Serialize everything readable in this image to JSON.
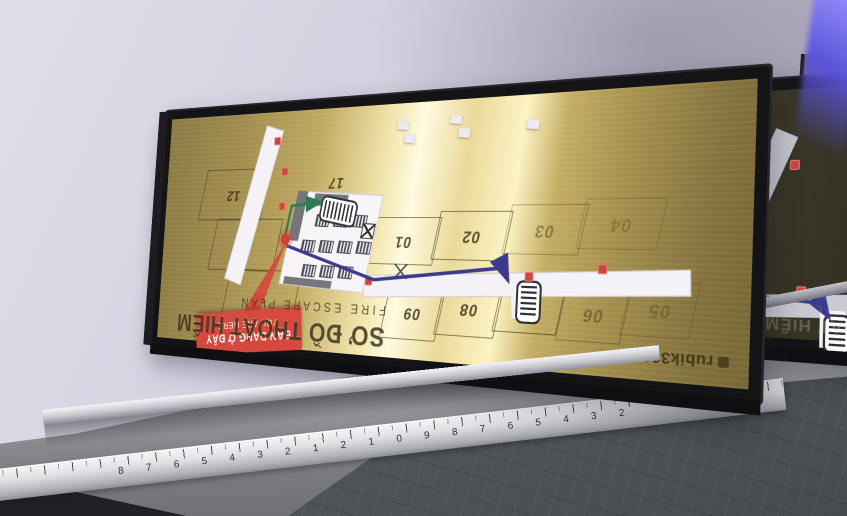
{
  "sign_main": {
    "title": "SƠ ĐỒ THOÁT HIỂM",
    "subtitle": "FIRE ESCAPE PLAN",
    "you_are_here": {
      "line1": "BẠN ĐANG Ở ĐÂY",
      "line2": "YOU ARE HERE"
    },
    "brand": "rubik360",
    "rooms": [
      "12",
      "11",
      "10",
      "17",
      "01",
      "02",
      "03",
      "04",
      "09",
      "08",
      "07",
      "06",
      "05"
    ],
    "icons": [
      "stairs-icon",
      "fire-extinguisher-icon",
      "elevator-icon",
      "door-swing-icon",
      "you-are-here-dot",
      "route-arrow",
      "desk-cluster-icon"
    ],
    "colors": {
      "brass": "#c9b46a",
      "frame": "#141417",
      "corridor": "#f4f2f6",
      "route_green": "#2e7d4f",
      "route_navy": "#3b3b8e",
      "marker_red": "#d0453c",
      "tag_red": "#d6493f"
    }
  },
  "sign_right": {
    "title": "SƠ ĐỒ THOÁT HIỂM",
    "subtitle": "FIRE ESCAPE PLAN"
  },
  "ruler": {
    "numbers": [
      "8",
      "7",
      "6",
      "5",
      "4",
      "3",
      "2",
      "1",
      "2",
      "1",
      "0",
      "9",
      "8",
      "7",
      "6",
      "5",
      "4",
      "3",
      "2"
    ]
  }
}
